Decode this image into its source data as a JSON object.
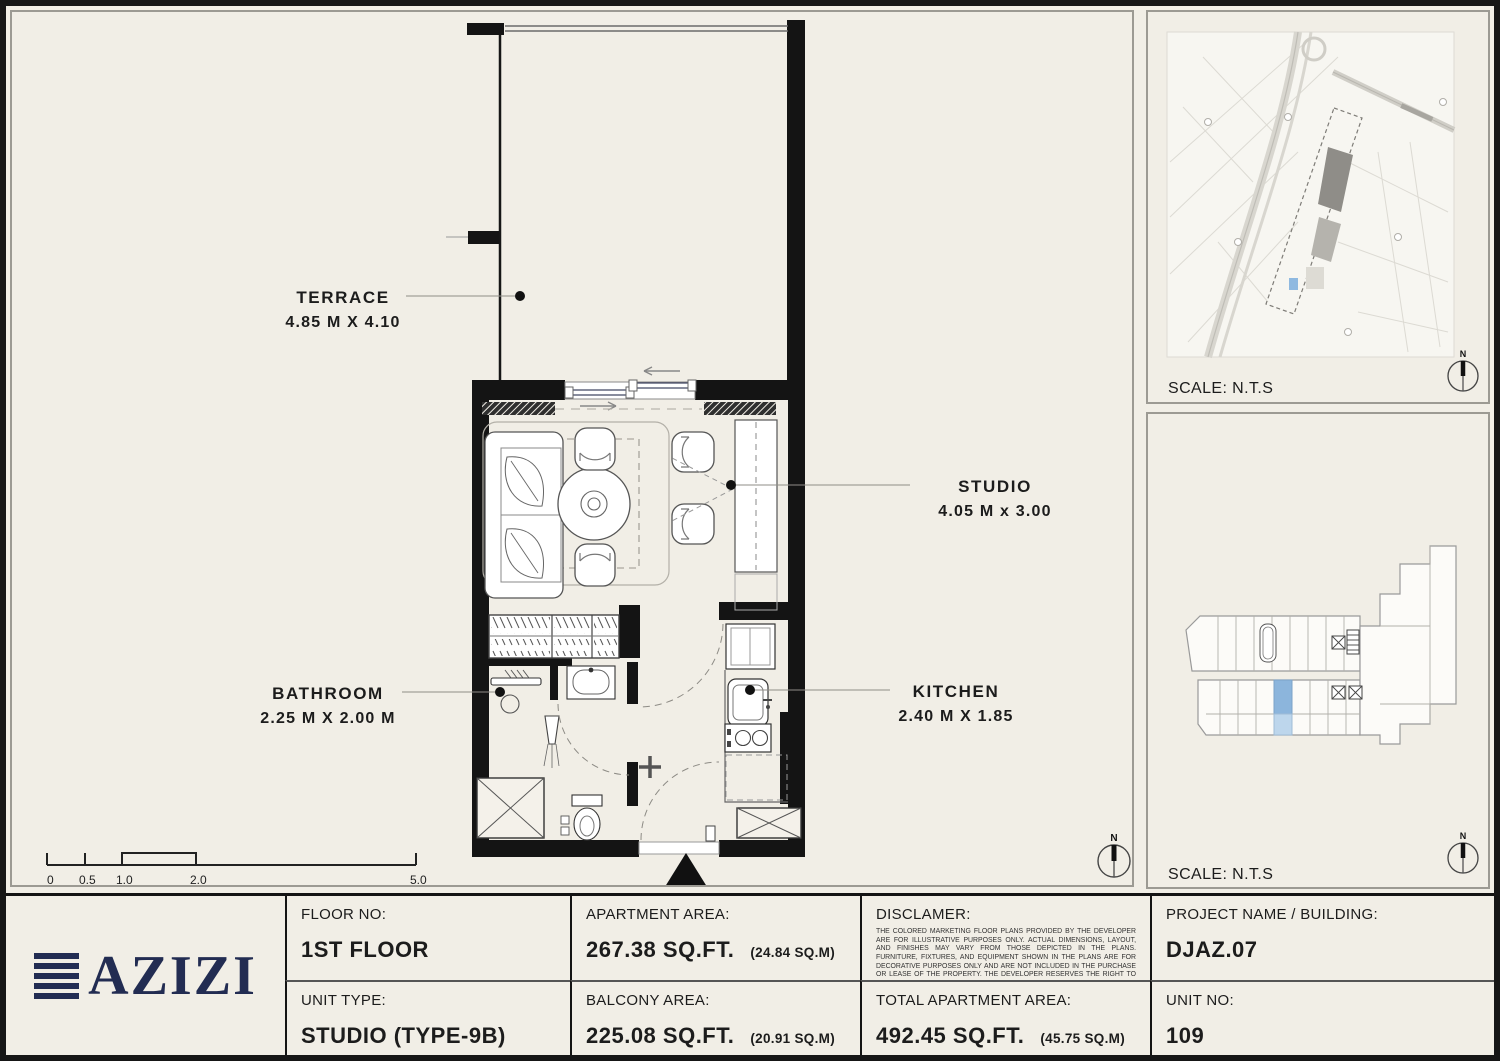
{
  "plan": {
    "rooms": {
      "terrace": {
        "name": "TERRACE",
        "dims": "4.85 M X 4.10"
      },
      "studio": {
        "name": "STUDIO",
        "dims": "4.05 M x 3.00"
      },
      "bathroom": {
        "name": "BATHROOM",
        "dims": "2.25 M X 2.00 M"
      },
      "kitchen": {
        "name": "KITCHEN",
        "dims": "2.40 M X 1.85"
      }
    },
    "scale_bar_ticks": [
      "0",
      "0.5",
      "1.0",
      "2.0",
      "5.0"
    ],
    "compass_label": "N"
  },
  "map_panel": {
    "scale_note": "SCALE: N.T.S"
  },
  "key_panel": {
    "scale_note": "SCALE: N.T.S"
  },
  "colors": {
    "background": "#f1eee6",
    "wall_black": "#141414",
    "brand_navy": "#222c52",
    "unit_highlight": "#8cb5dc",
    "unit_highlight_light": "#bdd6ec"
  },
  "title_block": {
    "brand": "AZIZI",
    "floor": {
      "label": "FLOOR NO:",
      "value": "1ST FLOOR"
    },
    "unit_type": {
      "label": "UNIT TYPE:",
      "value": "STUDIO (TYPE-9B)"
    },
    "apartment_area": {
      "label": "APARTMENT AREA:",
      "value": "267.38 SQ.FT.",
      "metric": "(24.84 SQ.M)"
    },
    "balcony_area": {
      "label": "BALCONY AREA:",
      "value": "225.08 SQ.FT.",
      "metric": "(20.91 SQ.M)"
    },
    "disclaimer": {
      "label": "DISCLAMER:",
      "body": "THE COLORED MARKETING FLOOR PLANS PROVIDED BY THE DEVELOPER ARE FOR ILLUSTRATIVE PURPOSES ONLY. ACTUAL DIMENSIONS, LAYOUT, AND FINISHES MAY VARY FROM THOSE DEPICTED IN THE PLANS. FURNITURE, FIXTURES, AND EQUIPMENT SHOWN IN THE PLANS ARE FOR DECORATIVE PURPOSES ONLY AND ARE NOT INCLUDED IN THE PURCHASE OR LEASE OF THE PROPERTY. THE DEVELOPER RESERVES THE RIGHT TO MAKE MODIFICATIONS, REVISIONS, AND CHANGES TO THE FLOOR PLANS, SPECIFICATIONS, AND FEATURES WITHOUT PRIOR NOTICE."
    },
    "total_area": {
      "label": "TOTAL APARTMENT AREA:",
      "value": "492.45 SQ.FT.",
      "metric": "(45.75 SQ.M)"
    },
    "project": {
      "label": "PROJECT NAME / BUILDING:",
      "value": "DJAZ.07"
    },
    "unit_no": {
      "label": "UNIT NO:",
      "value": "109"
    }
  }
}
